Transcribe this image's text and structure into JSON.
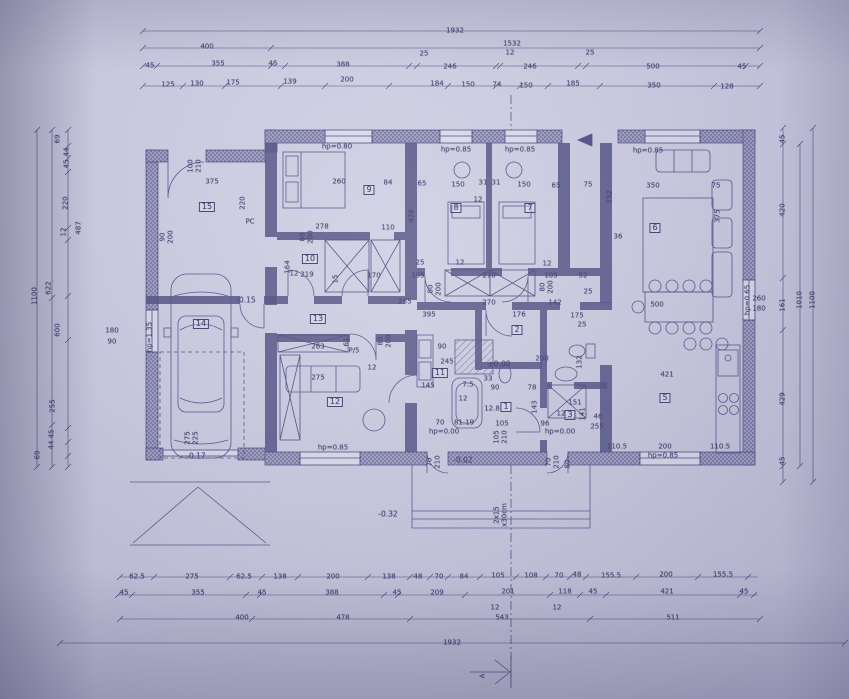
{
  "meta": {
    "drawing_type": "architectural floor plan (photographed blueprint)",
    "paper_color": "#cfcfe3",
    "ink_color": "#3c3c6a"
  },
  "room_tags": [
    {
      "t": "15",
      "x": 207,
      "y": 207
    },
    {
      "t": "9",
      "x": 369,
      "y": 190
    },
    {
      "t": "8",
      "x": 456,
      "y": 208
    },
    {
      "t": "7",
      "x": 530,
      "y": 208
    },
    {
      "t": "6",
      "x": 655,
      "y": 228
    },
    {
      "t": "10",
      "x": 310,
      "y": 259
    },
    {
      "t": "13",
      "x": 318,
      "y": 319
    },
    {
      "t": "14",
      "x": 201,
      "y": 324
    },
    {
      "t": "12",
      "x": 335,
      "y": 402
    },
    {
      "t": "11",
      "x": 440,
      "y": 373
    },
    {
      "t": "2",
      "x": 517,
      "y": 330
    },
    {
      "t": "1",
      "x": 506,
      "y": 407
    },
    {
      "t": "3",
      "x": 570,
      "y": 415
    },
    {
      "t": "5",
      "x": 665,
      "y": 398
    }
  ],
  "dims_top": [
    {
      "t": "1932",
      "x": 455,
      "y": 31
    },
    {
      "t": "400",
      "x": 207,
      "y": 47
    },
    {
      "t": "1532",
      "x": 512,
      "y": 44
    },
    {
      "t": "12",
      "x": 510,
      "y": 53
    },
    {
      "t": "25",
      "x": 424,
      "y": 54
    },
    {
      "t": "25",
      "x": 590,
      "y": 53
    },
    {
      "t": "45",
      "x": 150,
      "y": 66
    },
    {
      "t": "355",
      "x": 218,
      "y": 64
    },
    {
      "t": "45",
      "x": 273,
      "y": 64
    },
    {
      "t": "388",
      "x": 343,
      "y": 65
    },
    {
      "t": "246",
      "x": 450,
      "y": 67
    },
    {
      "t": "246",
      "x": 530,
      "y": 67
    },
    {
      "t": "500",
      "x": 653,
      "y": 67
    },
    {
      "t": "45",
      "x": 742,
      "y": 67
    },
    {
      "t": "125",
      "x": 168,
      "y": 85
    },
    {
      "t": "130",
      "x": 197,
      "y": 84
    },
    {
      "t": "175",
      "x": 233,
      "y": 83
    },
    {
      "t": "139",
      "x": 290,
      "y": 82
    },
    {
      "t": "200",
      "x": 347,
      "y": 80
    },
    {
      "t": "184",
      "x": 437,
      "y": 84
    },
    {
      "t": "150",
      "x": 468,
      "y": 85
    },
    {
      "t": "74",
      "x": 497,
      "y": 85
    },
    {
      "t": "150",
      "x": 526,
      "y": 86
    },
    {
      "t": "185",
      "x": 573,
      "y": 84
    },
    {
      "t": "350",
      "x": 654,
      "y": 86
    },
    {
      "t": "128",
      "x": 727,
      "y": 87
    }
  ],
  "dims_bottom": [
    {
      "t": "62.5",
      "x": 137,
      "y": 577
    },
    {
      "t": "275",
      "x": 192,
      "y": 577
    },
    {
      "t": "62.5",
      "x": 244,
      "y": 577
    },
    {
      "t": "138",
      "x": 280,
      "y": 577
    },
    {
      "t": "200",
      "x": 333,
      "y": 577
    },
    {
      "t": "138",
      "x": 389,
      "y": 577
    },
    {
      "t": "48",
      "x": 418,
      "y": 577
    },
    {
      "t": "70",
      "x": 439,
      "y": 577
    },
    {
      "t": "84",
      "x": 464,
      "y": 577
    },
    {
      "t": "105",
      "x": 498,
      "y": 576
    },
    {
      "t": "108",
      "x": 531,
      "y": 576
    },
    {
      "t": "70",
      "x": 559,
      "y": 576
    },
    {
      "t": "48",
      "x": 577,
      "y": 575
    },
    {
      "t": "155.5",
      "x": 611,
      "y": 576
    },
    {
      "t": "200",
      "x": 666,
      "y": 575
    },
    {
      "t": "155.5",
      "x": 723,
      "y": 575
    },
    {
      "t": "45",
      "x": 124,
      "y": 593
    },
    {
      "t": "355",
      "x": 198,
      "y": 593
    },
    {
      "t": "45",
      "x": 262,
      "y": 593
    },
    {
      "t": "388",
      "x": 332,
      "y": 593
    },
    {
      "t": "45",
      "x": 397,
      "y": 593
    },
    {
      "t": "209",
      "x": 437,
      "y": 593
    },
    {
      "t": "201",
      "x": 508,
      "y": 592
    },
    {
      "t": "118",
      "x": 565,
      "y": 592
    },
    {
      "t": "45",
      "x": 593,
      "y": 592
    },
    {
      "t": "421",
      "x": 667,
      "y": 592
    },
    {
      "t": "45",
      "x": 744,
      "y": 592
    },
    {
      "t": "12",
      "x": 495,
      "y": 608
    },
    {
      "t": "543",
      "x": 502,
      "y": 618
    },
    {
      "t": "12",
      "x": 557,
      "y": 608
    },
    {
      "t": "400",
      "x": 242,
      "y": 618
    },
    {
      "t": "478",
      "x": 343,
      "y": 618
    },
    {
      "t": "511",
      "x": 673,
      "y": 618
    },
    {
      "t": "1932",
      "x": 452,
      "y": 643
    }
  ],
  "dims_left": [
    {
      "t": "1100",
      "x": 35,
      "y": 296,
      "r": 1
    },
    {
      "t": "622",
      "x": 49,
      "y": 288,
      "r": 1
    },
    {
      "t": "600",
      "x": 58,
      "y": 330,
      "r": 1
    },
    {
      "t": "255",
      "x": 53,
      "y": 406,
      "r": 1
    },
    {
      "t": "487",
      "x": 79,
      "y": 228,
      "r": 1
    },
    {
      "t": "220",
      "x": 66,
      "y": 203,
      "r": 1
    },
    {
      "t": "12",
      "x": 64,
      "y": 232,
      "r": 1
    },
    {
      "t": "45",
      "x": 67,
      "y": 164,
      "r": 1
    },
    {
      "t": "44",
      "x": 67,
      "y": 152,
      "r": 1
    },
    {
      "t": "69",
      "x": 58,
      "y": 139,
      "r": 1
    },
    {
      "t": "45",
      "x": 52,
      "y": 434,
      "r": 1
    },
    {
      "t": "44",
      "x": 52,
      "y": 445,
      "r": 1
    },
    {
      "t": "69",
      "x": 38,
      "y": 455,
      "r": 1
    },
    {
      "t": "180",
      "x": 112,
      "y": 331
    },
    {
      "t": "90",
      "x": 112,
      "y": 342
    }
  ],
  "dims_right": [
    {
      "t": "45",
      "x": 783,
      "y": 139,
      "r": 1
    },
    {
      "t": "420",
      "x": 783,
      "y": 210,
      "r": 1
    },
    {
      "t": "161",
      "x": 783,
      "y": 305,
      "r": 1
    },
    {
      "t": "429",
      "x": 783,
      "y": 399,
      "r": 1
    },
    {
      "t": "45",
      "x": 783,
      "y": 461,
      "r": 1
    },
    {
      "t": "1010",
      "x": 800,
      "y": 300,
      "r": 1
    },
    {
      "t": "1100",
      "x": 813,
      "y": 300,
      "r": 1
    },
    {
      "t": "260",
      "x": 759,
      "y": 299
    },
    {
      "t": "180",
      "x": 759,
      "y": 309
    }
  ],
  "dims_interior": [
    {
      "t": "375",
      "x": 212,
      "y": 182
    },
    {
      "t": "220",
      "x": 243,
      "y": 203,
      "r": 1
    },
    {
      "t": "100",
      "x": 191,
      "y": 166,
      "r": 1
    },
    {
      "t": "210",
      "x": 199,
      "y": 166,
      "r": 1
    },
    {
      "t": "90",
      "x": 163,
      "y": 237,
      "r": 1
    },
    {
      "t": "200",
      "x": 171,
      "y": 237,
      "r": 1
    },
    {
      "t": "260",
      "x": 339,
      "y": 182
    },
    {
      "t": "84",
      "x": 388,
      "y": 183
    },
    {
      "t": "278",
      "x": 322,
      "y": 227
    },
    {
      "t": "110",
      "x": 388,
      "y": 228
    },
    {
      "t": "80",
      "x": 303,
      "y": 237,
      "r": 1
    },
    {
      "t": "200",
      "x": 311,
      "y": 237,
      "r": 1
    },
    {
      "t": "12",
      "x": 294,
      "y": 274
    },
    {
      "t": "219",
      "x": 307,
      "y": 275
    },
    {
      "t": "15",
      "x": 336,
      "y": 279,
      "r": 1
    },
    {
      "t": "170",
      "x": 374,
      "y": 276
    },
    {
      "t": "164",
      "x": 288,
      "y": 267,
      "r": 1
    },
    {
      "t": "65",
      "x": 422,
      "y": 184
    },
    {
      "t": "150",
      "x": 458,
      "y": 185
    },
    {
      "t": "31",
      "x": 483,
      "y": 183
    },
    {
      "t": "31",
      "x": 496,
      "y": 183
    },
    {
      "t": "150",
      "x": 524,
      "y": 185
    },
    {
      "t": "65",
      "x": 556,
      "y": 186
    },
    {
      "t": "75",
      "x": 588,
      "y": 185
    },
    {
      "t": "12",
      "x": 478,
      "y": 200
    },
    {
      "t": "478",
      "x": 412,
      "y": 216,
      "r": 1
    },
    {
      "t": "332",
      "x": 610,
      "y": 197,
      "r": 1
    },
    {
      "t": "25",
      "x": 420,
      "y": 263
    },
    {
      "t": "12",
      "x": 460,
      "y": 263
    },
    {
      "t": "105",
      "x": 418,
      "y": 276
    },
    {
      "t": "270",
      "x": 489,
      "y": 276
    },
    {
      "t": "12",
      "x": 547,
      "y": 264
    },
    {
      "t": "105",
      "x": 551,
      "y": 276
    },
    {
      "t": "52",
      "x": 583,
      "y": 276
    },
    {
      "t": "25",
      "x": 588,
      "y": 292
    },
    {
      "t": "80",
      "x": 431,
      "y": 289,
      "r": 1
    },
    {
      "t": "200",
      "x": 439,
      "y": 289,
      "r": 1
    },
    {
      "t": "80",
      "x": 543,
      "y": 287,
      "r": 1
    },
    {
      "t": "200",
      "x": 551,
      "y": 287,
      "r": 1
    },
    {
      "t": "255",
      "x": 405,
      "y": 302
    },
    {
      "t": "270",
      "x": 489,
      "y": 303
    },
    {
      "t": "142",
      "x": 555,
      "y": 303
    },
    {
      "t": "395",
      "x": 429,
      "y": 315
    },
    {
      "t": "176",
      "x": 519,
      "y": 315
    },
    {
      "t": "175",
      "x": 577,
      "y": 316
    },
    {
      "t": "25",
      "x": 582,
      "y": 325
    },
    {
      "t": "350",
      "x": 653,
      "y": 186
    },
    {
      "t": "75",
      "x": 716,
      "y": 186
    },
    {
      "t": "375",
      "x": 718,
      "y": 216,
      "r": 1
    },
    {
      "t": "36",
      "x": 618,
      "y": 237
    },
    {
      "t": "500",
      "x": 657,
      "y": 305
    },
    {
      "t": "421",
      "x": 667,
      "y": 375
    },
    {
      "t": "245",
      "x": 447,
      "y": 362
    },
    {
      "t": "145",
      "x": 428,
      "y": 386
    },
    {
      "t": "90",
      "x": 442,
      "y": 347
    },
    {
      "t": "7.5",
      "x": 468,
      "y": 385
    },
    {
      "t": "12",
      "x": 463,
      "y": 399
    },
    {
      "t": "33",
      "x": 488,
      "y": 379
    },
    {
      "t": "90",
      "x": 495,
      "y": 388
    },
    {
      "t": "12.8",
      "x": 492,
      "y": 409
    },
    {
      "t": "70",
      "x": 440,
      "y": 423
    },
    {
      "t": "81.19",
      "x": 464,
      "y": 423
    },
    {
      "t": "105",
      "x": 502,
      "y": 424
    },
    {
      "t": "96",
      "x": 545,
      "y": 424
    },
    {
      "t": "200",
      "x": 542,
      "y": 359
    },
    {
      "t": "78",
      "x": 532,
      "y": 388
    },
    {
      "t": "132",
      "x": 580,
      "y": 362,
      "r": 1
    },
    {
      "t": "151",
      "x": 575,
      "y": 403
    },
    {
      "t": "12",
      "x": 561,
      "y": 414
    },
    {
      "t": "141",
      "x": 583,
      "y": 414,
      "r": 1
    },
    {
      "t": "143",
      "x": 535,
      "y": 407,
      "r": 1
    },
    {
      "t": "46",
      "x": 598,
      "y": 417
    },
    {
      "t": "255",
      "x": 597,
      "y": 427
    },
    {
      "t": "110.5",
      "x": 617,
      "y": 447
    },
    {
      "t": "200",
      "x": 665,
      "y": 447
    },
    {
      "t": "110.5",
      "x": 720,
      "y": 447
    },
    {
      "t": "105",
      "x": 497,
      "y": 437,
      "r": 1
    },
    {
      "t": "210",
      "x": 505,
      "y": 437,
      "r": 1
    },
    {
      "t": "70",
      "x": 430,
      "y": 462,
      "r": 1
    },
    {
      "t": "210",
      "x": 438,
      "y": 462,
      "r": 1
    },
    {
      "t": "70",
      "x": 549,
      "y": 462,
      "r": 1
    },
    {
      "t": "210",
      "x": 557,
      "y": 462,
      "r": 1
    },
    {
      "t": "80",
      "x": 568,
      "y": 464,
      "r": 1
    },
    {
      "t": "275",
      "x": 188,
      "y": 438,
      "r": 1
    },
    {
      "t": "225",
      "x": 196,
      "y": 438,
      "r": 1
    },
    {
      "t": "263",
      "x": 318,
      "y": 347
    },
    {
      "t": "61",
      "x": 347,
      "y": 342,
      "r": 1
    },
    {
      "t": "275",
      "x": 318,
      "y": 378
    },
    {
      "t": "12",
      "x": 372,
      "y": 368
    },
    {
      "t": "80",
      "x": 381,
      "y": 341,
      "r": 1
    },
    {
      "t": "200",
      "x": 389,
      "y": 341,
      "r": 1
    }
  ],
  "window_heights": [
    {
      "t": "hp=0.80",
      "x": 337,
      "y": 147
    },
    {
      "t": "hp=0.85",
      "x": 456,
      "y": 150
    },
    {
      "t": "hp=0.85",
      "x": 520,
      "y": 150
    },
    {
      "t": "hp=0.85",
      "x": 648,
      "y": 151
    },
    {
      "t": "hp=0.85",
      "x": 333,
      "y": 448
    },
    {
      "t": "hp=0.85",
      "x": 663,
      "y": 456
    },
    {
      "t": "hp=0.65",
      "x": 748,
      "y": 300,
      "r": 1
    },
    {
      "t": "hp=0.00",
      "x": 444,
      "y": 432
    },
    {
      "t": "hp=0.00",
      "x": 560,
      "y": 432
    },
    {
      "t": "hp=1.35",
      "x": 150,
      "y": 337,
      "r": 1
    }
  ],
  "levels": [
    {
      "t": "-0.15",
      "x": 246,
      "y": 300
    },
    {
      "t": "-0.17",
      "x": 196,
      "y": 456
    },
    {
      "t": "-0.02",
      "x": 463,
      "y": 460
    },
    {
      "t": "-0.32",
      "x": 388,
      "y": 514
    },
    {
      "t": "±0.00",
      "x": 499,
      "y": 364
    }
  ],
  "misc": [
    {
      "t": "PC",
      "x": 250,
      "y": 222
    },
    {
      "t": "P/5",
      "x": 354,
      "y": 351
    },
    {
      "t": "A",
      "x": 483,
      "y": 676,
      "r": 1
    },
    {
      "t": "2x15",
      "x": 497,
      "y": 515,
      "r": 1
    },
    {
      "t": "x30cm",
      "x": 505,
      "y": 515,
      "r": 1
    }
  ]
}
